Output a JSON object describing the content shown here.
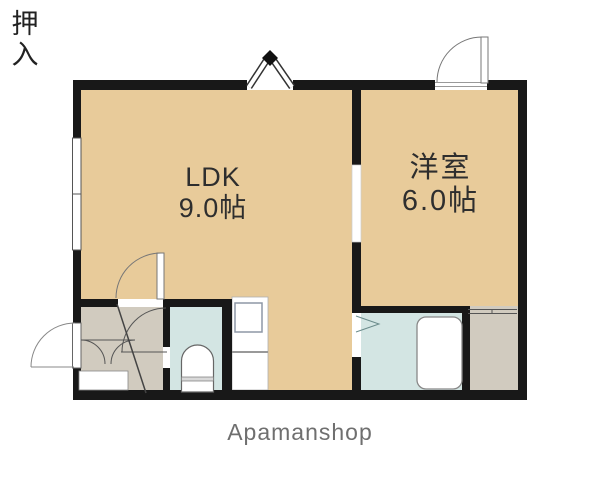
{
  "floorplan": {
    "rooms": {
      "ldk": {
        "name": "LDK",
        "size": "9.0帖"
      },
      "western": {
        "name": "洋室",
        "size": "6.0帖"
      },
      "closet": {
        "name": "押入"
      }
    },
    "brand": "Apamanshop",
    "colors": {
      "wall": "#181818",
      "room_tan": "#e8cb9a",
      "service_gray": "#d1cbbf",
      "wet_area_blue": "#d3e5e3",
      "fixture_white": "#ffffff",
      "label_text": "#2e2e2e",
      "brand_text": "#6f6f6f"
    },
    "fixtures": {
      "entry_door": "entry-door",
      "ldk_door": "ldk-door",
      "western_room_door": "western-room-door",
      "toilet_door": "toilet-door",
      "bath_folding_door": "bath-folding-door",
      "closet_sliding_door": "closet-sliding-door",
      "left_window": "sliding-window",
      "top_window": "casement-window",
      "toilet": "toilet",
      "bathtub": "bathtub",
      "kitchen_sink": "kitchen-sink",
      "washbasin": "washbasin",
      "entry_step": "entry-step"
    }
  }
}
